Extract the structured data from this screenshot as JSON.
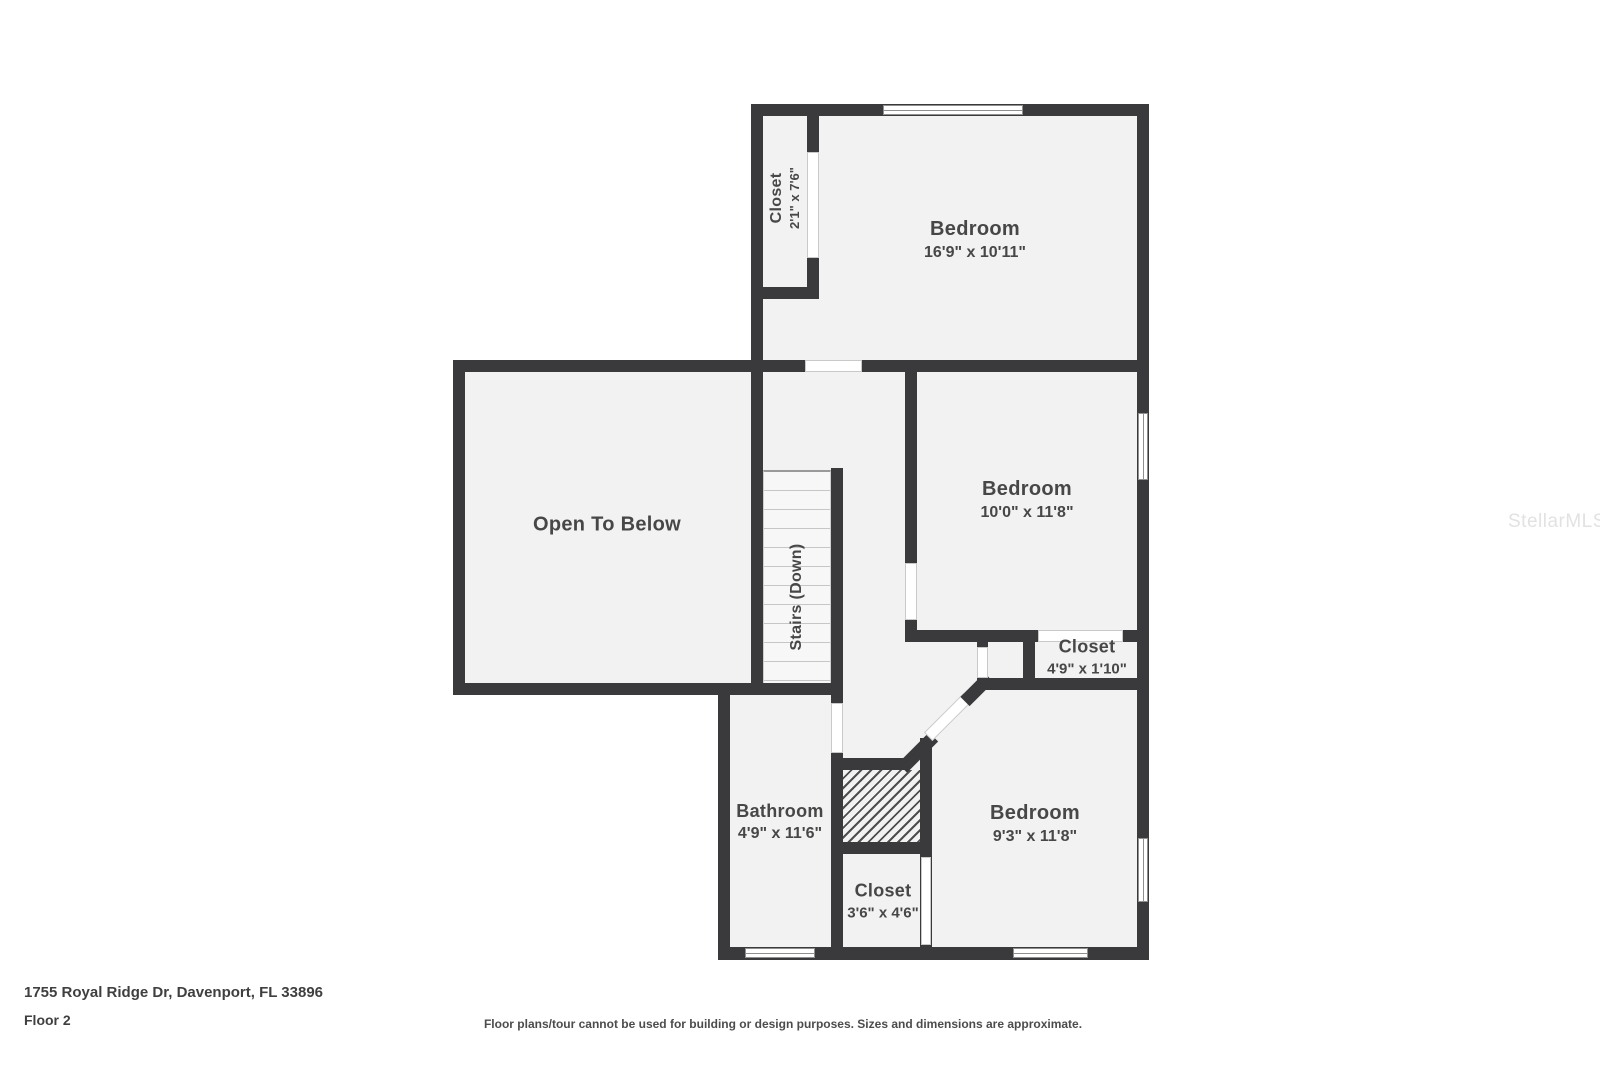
{
  "plan": {
    "rooms": [
      {
        "id": "closet-top",
        "label": "Closet",
        "dims": "2'1\" x 7'6\""
      },
      {
        "id": "bedroom-top",
        "label": "Bedroom",
        "dims": "16'9\" x 10'11\""
      },
      {
        "id": "open-to-below",
        "label": "Open To Below",
        "dims": ""
      },
      {
        "id": "stairs",
        "label": "Stairs (Down)",
        "dims": ""
      },
      {
        "id": "bedroom-mid",
        "label": "Bedroom",
        "dims": "10'0\" x 11'8\""
      },
      {
        "id": "closet-mid",
        "label": "Closet",
        "dims": "4'9\" x 1'10\""
      },
      {
        "id": "bathroom",
        "label": "Bathroom",
        "dims": "4'9\" x 11'6\""
      },
      {
        "id": "closet-bottom",
        "label": "Closet",
        "dims": "3'6\" x 4'6\""
      },
      {
        "id": "bedroom-bottom",
        "label": "Bedroom",
        "dims": "9'3\" x 11'8\""
      }
    ]
  },
  "footer": {
    "address": "1755 Royal Ridge Dr, Davenport, FL 33896",
    "floor_label": "Floor 2",
    "disclaimer": "Floor plans/tour cannot be used for building or design purposes. Sizes and dimensions are approximate."
  },
  "watermark": "StellarMLS",
  "colors": {
    "wall": "#3a3a3c",
    "floor": "#f2f2f2",
    "text": "#474747",
    "watermark": "#e2e2e2",
    "background": "#ffffff"
  }
}
